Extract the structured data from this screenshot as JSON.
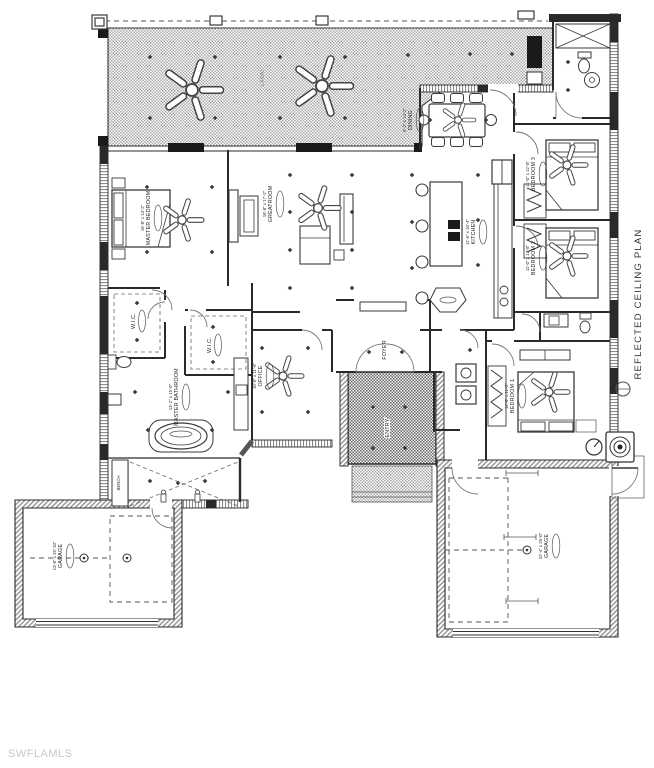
{
  "watermark": "SWFLAMLS",
  "annotation": {
    "plan_title": "REFLECTED CEILING PLAN"
  },
  "rooms": {
    "lanai": {
      "name": "LANAI"
    },
    "dining": {
      "name": "DINING",
      "dims": "9'-2\" x 14'-2\""
    },
    "master_bedroom": {
      "name": "MASTER BEDROOM",
      "dims": "16'-8\" x 13'-2\""
    },
    "greatroom": {
      "name": "GREATROOM",
      "dims": "18'-8\" x 17'-2\""
    },
    "kitchen": {
      "name": "KITCHEN",
      "dims": "11'-6\" x 10'-4\""
    },
    "bedroom3": {
      "name": "BEDROOM 3",
      "dims": "11'-0\" x 12'-8\""
    },
    "bedroom2": {
      "name": "BEDROOM 2",
      "dims": "11'-0\" x 12'-8\""
    },
    "bedroom1": {
      "name": "BEDROOM 1",
      "dims": "12'-8\" x 11'-2\""
    },
    "wic1": {
      "name": "W.I.C."
    },
    "wic2": {
      "name": "W.I.C."
    },
    "office": {
      "name": "OFFICE",
      "dims": "10'-0\" x 11'-6\""
    },
    "foyer": {
      "name": "FOYER"
    },
    "entry": {
      "name": "ENTRY"
    },
    "master_bathroom": {
      "name": "MASTER BATHROOM",
      "dims": "13'-2\" x 15'-0\""
    },
    "bench": {
      "name": "BENCH"
    },
    "garage_left": {
      "name": "GARAGE",
      "dims": "13'-8\" x 25'-10\""
    },
    "garage_right": {
      "name": "GARAGE",
      "dims": "22'-4\" x 25'-0\""
    }
  },
  "colors": {
    "line": "#2a2a2a",
    "hatch_light": "#a9a9a9",
    "hatch_dark": "#6e6e6e",
    "watermark": "#c9c9c9"
  }
}
